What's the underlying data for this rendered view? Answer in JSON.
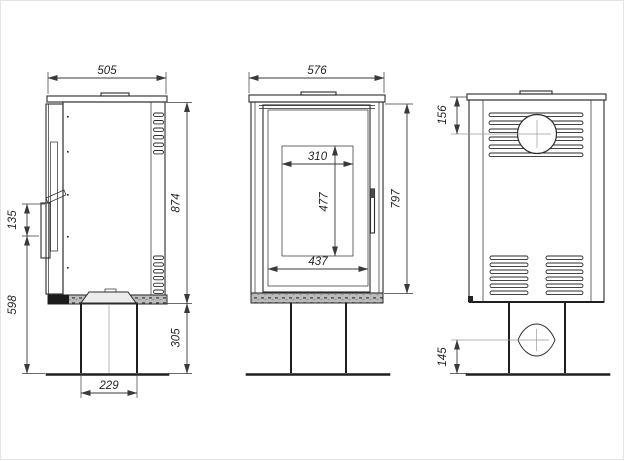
{
  "drawing": {
    "background": "#ffffff",
    "line_color": "#2b2b2b",
    "dimension_color": "#3a3a3a",
    "plate_fill": "#bcbcbc"
  },
  "views": {
    "side": {
      "label": "side-view",
      "width_top": "505",
      "height_body": "874",
      "height_pedestal": "305",
      "handle_length": "135",
      "handle_to_floor": "598",
      "pedestal_width": "229"
    },
    "front": {
      "label": "front-view",
      "width_top": "576",
      "height_body": "797",
      "glass_width": "310",
      "glass_height": "477",
      "door_inner_width": "437"
    },
    "back": {
      "label": "back-view",
      "flue_center_from_top": "156",
      "inlet_center_to_floor": "145"
    }
  }
}
